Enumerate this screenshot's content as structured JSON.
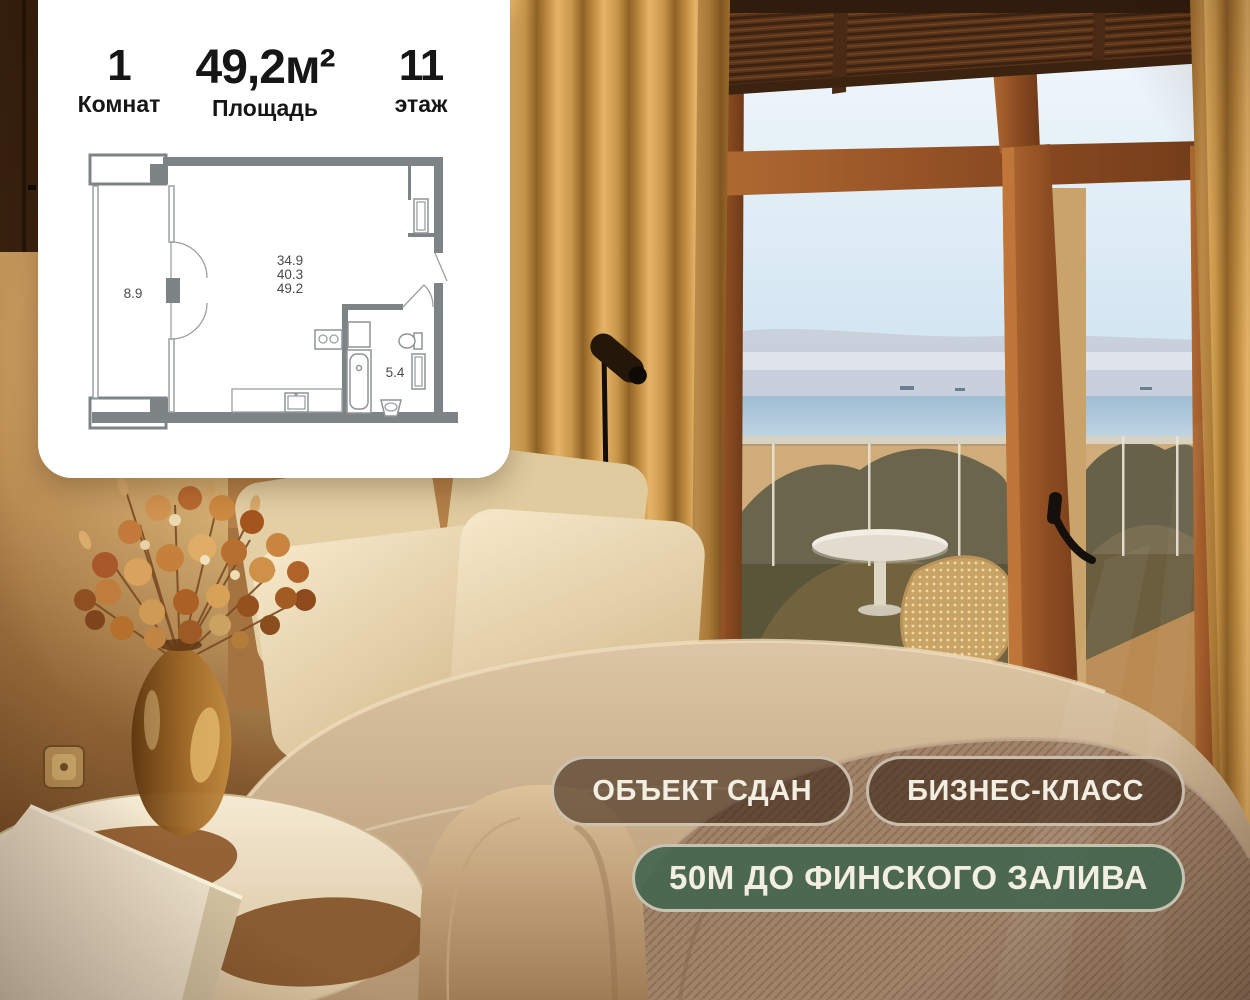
{
  "card": {
    "stats": [
      {
        "value": "1",
        "label": "Комнат"
      },
      {
        "value": "49,2м²",
        "label": "Площадь"
      },
      {
        "value": "11",
        "label": "этаж"
      }
    ],
    "floorplan": {
      "loggia_area": "8.9",
      "room_area_lines": [
        "34.9",
        "40.3",
        "49.2"
      ],
      "bathroom_area": "5.4"
    }
  },
  "badges": [
    {
      "label": "ОБЪЕКТ СДАН",
      "variant": "dark"
    },
    {
      "label": "БИЗНЕС-КЛАСС",
      "variant": "dark"
    },
    {
      "label": "50м ДО ФИНСКОГО ЗАЛИВА",
      "variant": "green"
    }
  ],
  "colors": {
    "badge_dark_bg": "rgba(58,36,22,0.60)",
    "badge_green_bg": "rgba(71,102,80,0.93)",
    "badge_border": "rgba(228,218,200,0.80)",
    "badge_text": "#f3eee2",
    "card_bg": "#ffffff",
    "stat_text": "#161616",
    "plan_wall": "#7e8486",
    "plan_line": "#9aa0a2",
    "plan_text": "#4a4a4a"
  }
}
